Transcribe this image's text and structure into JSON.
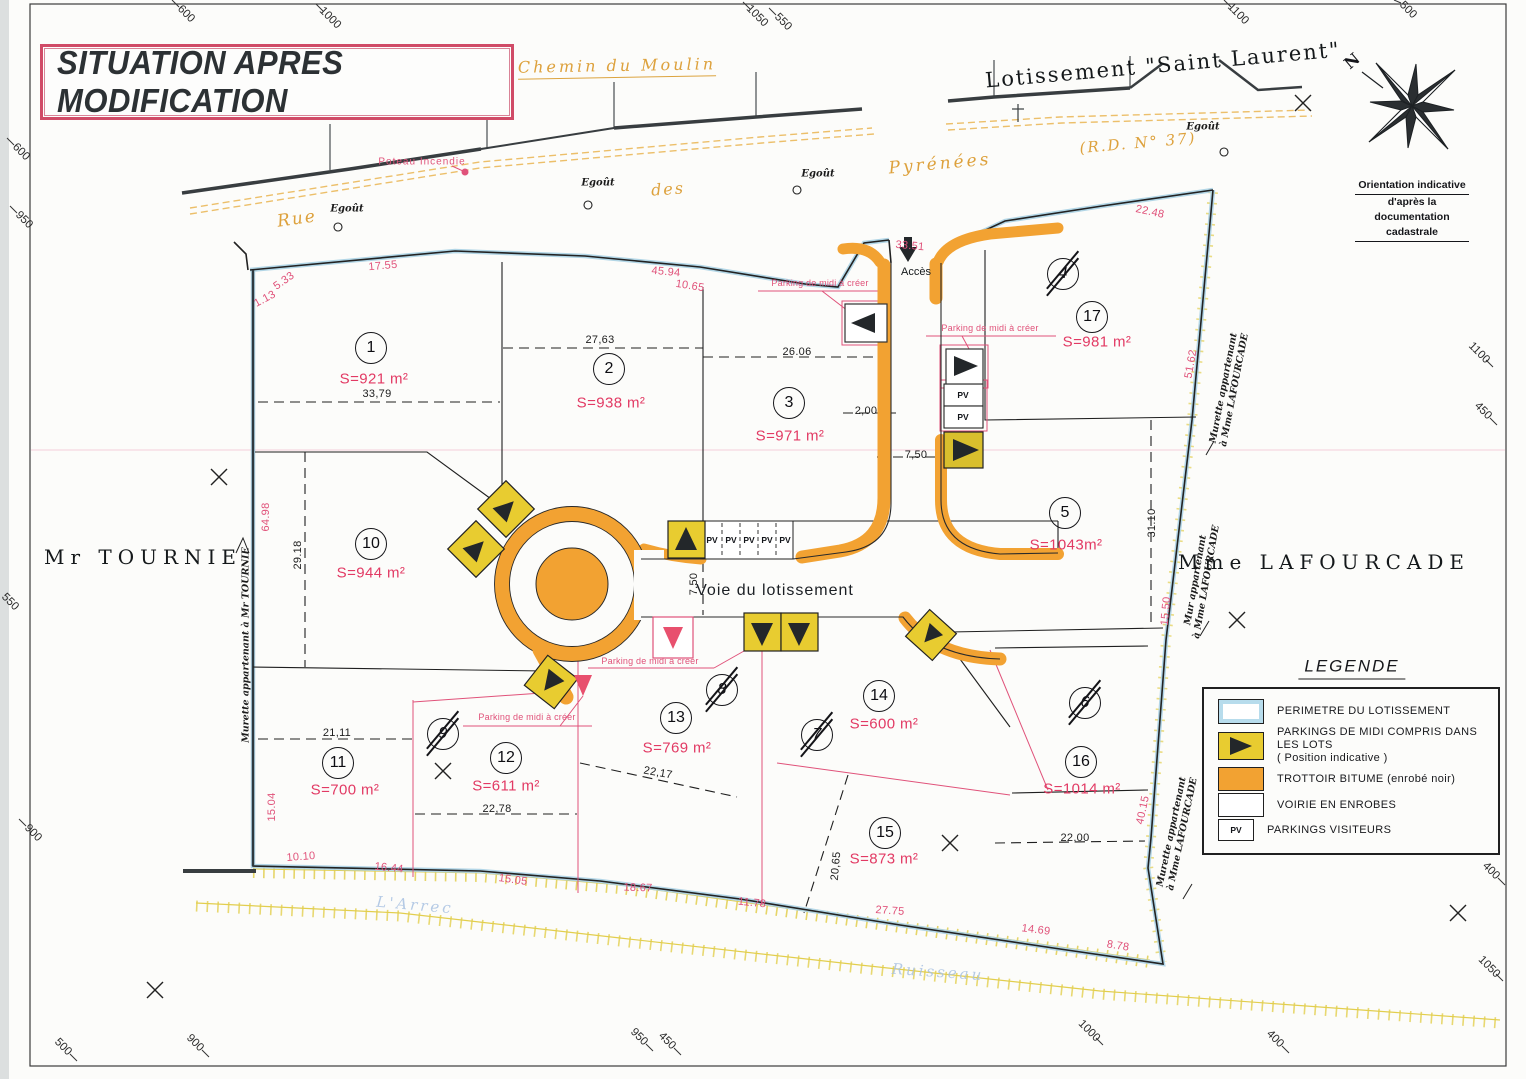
{
  "title": "SITUATION APRES MODIFICATION",
  "header": {
    "subdivision": "Lotissement \"Saint Laurent\"",
    "chemin": "Chemin du Moulin"
  },
  "roads": {
    "rue": "Rue",
    "des": "des",
    "pyrenees": "Pyrénées",
    "rd": "(R.D. N° 37)",
    "voie": "Voie du lotissement",
    "acces": "Accès"
  },
  "compass": {
    "north": "N",
    "caption1": "Orientation indicative",
    "caption2": "d'après la documentation cadastrale"
  },
  "owners": {
    "left": "Mr TOURNIE",
    "right": "Mme LAFOURCADE"
  },
  "walls": {
    "left": "Murette appartenant à Mr TOURNIE",
    "right_top_1": "Murette appartenant",
    "right_top_2": "à Mme LAFOURCADE",
    "right_mid_1": "Mur appartenant",
    "right_mid_2": "à Mme LAFOURCADE",
    "right_bottom_1": "Murette appartenant",
    "right_bottom_2": "à Mme LAFOURCADE"
  },
  "annotations": {
    "poteau": "Poteau Incendie",
    "egout": "Egoût",
    "parking": "Parking de midi à créer",
    "pv": "PV",
    "stream1": "L'Arrec",
    "stream2": "Ruisseau"
  },
  "legend": {
    "title": "LEGENDE",
    "items": [
      {
        "label": "PERIMETRE DU LOTISSEMENT"
      },
      {
        "label": "PARKINGS DE MIDI COMPRIS DANS LES LOTS",
        "label2": "( Position indicative )"
      },
      {
        "label": "TROTTOIR BITUME (enrobé noir)"
      },
      {
        "label": "VOIRIE EN ENROBES"
      },
      {
        "label": "PARKINGS VISITEURS"
      }
    ]
  },
  "lots": [
    {
      "n": "1",
      "a": "S=921 m²"
    },
    {
      "n": "2",
      "a": "S=938 m²"
    },
    {
      "n": "3",
      "a": "S=971 m²"
    },
    {
      "n": "17",
      "a": "S=981 m²"
    },
    {
      "n": "5",
      "a": "S=1043m²"
    },
    {
      "n": "10",
      "a": "S=944 m²"
    },
    {
      "n": "11",
      "a": "S=700 m²"
    },
    {
      "n": "12",
      "a": "S=611 m²"
    },
    {
      "n": "13",
      "a": "S=769 m²"
    },
    {
      "n": "14",
      "a": "S=600 m²"
    },
    {
      "n": "15",
      "a": "S=873 m²"
    },
    {
      "n": "16",
      "a": "S=1014 m²"
    }
  ],
  "deleted_lots": [
    "4",
    "9",
    "8",
    "7",
    "6"
  ],
  "dims_pink": [
    "5.33",
    "1.13",
    "17.55",
    "10.65",
    "45.94",
    "33.51",
    "22.48",
    "51.62",
    "64.98",
    "15.04",
    "10.10",
    "16.44",
    "15.05",
    "18.67",
    "11.78",
    "27.75",
    "14.69",
    "8.78",
    "40.15",
    "15.50"
  ],
  "dims_black": [
    "27,63",
    "33,79",
    "26.06",
    "2,00",
    "7,50",
    "7,50",
    "21,11",
    "22,78",
    "22,17",
    "20,65",
    "29.18",
    "31.10",
    "22,00"
  ],
  "grid_labels": [
    "600",
    "1000",
    "1050",
    "550",
    "1100",
    "500",
    "600",
    "950",
    "550",
    "900",
    "500",
    "900",
    "950",
    "450",
    "1000",
    "400",
    "1100",
    "450",
    "400",
    "1050"
  ]
}
